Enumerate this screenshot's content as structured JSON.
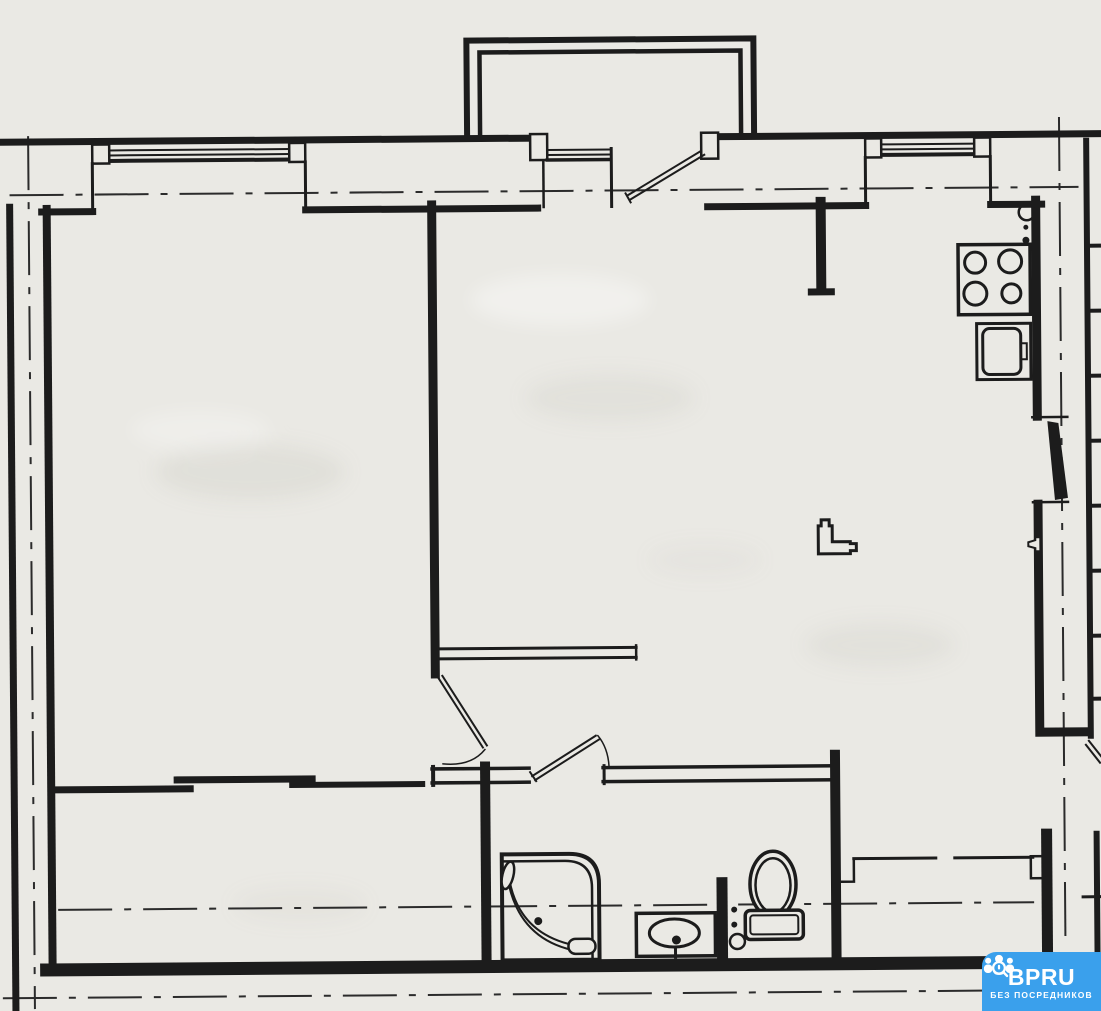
{
  "document": {
    "type": "Scanned apartment floor plan",
    "paper_color": "#EAE9E4",
    "ink_color": "#1C1C1C"
  },
  "watermark": {
    "brand": "BPRU",
    "tagline": "БЕЗ ПОСРЕДНИКОВ",
    "background_color": "#3AA0EC",
    "text_color": "#FFFFFF",
    "icon": "people-search-icon"
  },
  "plan": {
    "architecture": [
      "outer-walls",
      "left-party-wall",
      "axis-centerlines",
      "window-top-left",
      "window-top-right",
      "entrance-porch",
      "entrance-door-with-transom",
      "interior-wall-left-room",
      "corridor-partition",
      "bathroom-walls",
      "interior-door-left-room",
      "interior-door-bathroom",
      "service-hatch-right-wall",
      "stair-rungs-right",
      "demolished-wall-thin-line"
    ],
    "fixtures": [
      {
        "name": "stove-4-burner-icon",
        "zone": "kitchen"
      },
      {
        "name": "kitchen-sink-icon",
        "zone": "kitchen"
      },
      {
        "name": "gas-riser-icon",
        "zone": "kitchen"
      },
      {
        "name": "shower-cabin-icon",
        "zone": "bathroom"
      },
      {
        "name": "washbasin-icon",
        "zone": "bathroom"
      },
      {
        "name": "toilet-icon",
        "zone": "bathroom"
      },
      {
        "name": "pipe-riser-icon",
        "zone": "bathroom"
      },
      {
        "name": "vent-elbow-icon",
        "zone": "living-room"
      },
      {
        "name": "wall-valve-icon",
        "zone": "kitchen-wall"
      }
    ]
  }
}
